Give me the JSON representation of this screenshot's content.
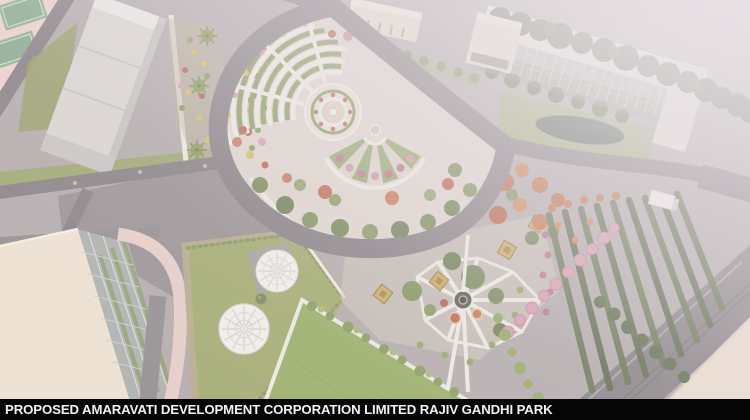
{
  "banner": {
    "text": "PROPOSED AMARAVATI DEVELOPMENT CORPORATION LIMITED RAJIV GANDHI PARK"
  },
  "palette": {
    "ground": "#aca4a5",
    "road": "#7b757a",
    "plaza": "#8f898b",
    "pinkPlaza": "#eed0cb",
    "court": "#85ab90",
    "lawn": "#9aa562",
    "lawnBright": "#90a958",
    "paving": "#ddd3cb",
    "pathWhite": "#efebe4",
    "buildingWhite": "#d8d5d2",
    "buildingCream": "#eee3d1",
    "buildingBeige": "#e3d8c6",
    "glass": "#b3b8b0",
    "treeDark": "#4d5a40",
    "treeMid": "#6d8148",
    "treeLight": "#869b5d",
    "hedgeRow": "#55673f",
    "pond": "#465a4c",
    "flowerPink": "#d795ab",
    "flowerRed": "#b5523c",
    "flowerOrange": "#c4683c",
    "flowerYellow": "#d2bb4d",
    "flowerMagenta": "#b0688c",
    "dome": "#f2f1ee",
    "pergola": "#c9a452",
    "pinkPath": "#e7cdc5",
    "cornerCream": "#ecdccd",
    "bannerBg": "#060606",
    "bannerText": "#f2f2f2"
  }
}
